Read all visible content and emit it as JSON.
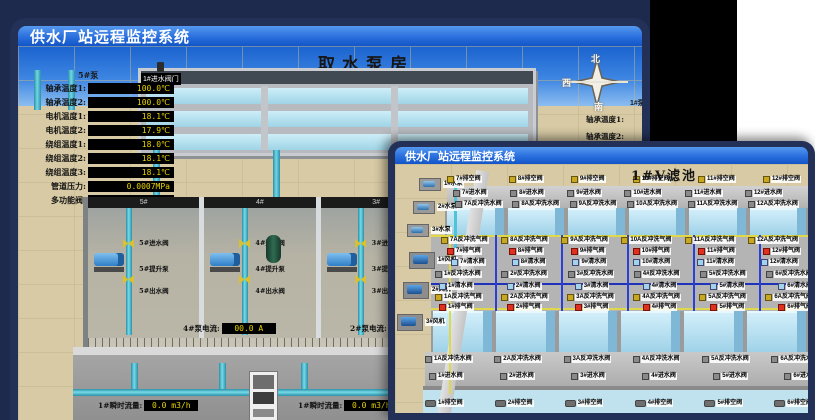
{
  "colors": {
    "titlebar_blue": "#2a6fdd",
    "value_yellow": "#e8d400",
    "alarm_red": "#e03020",
    "pipe_cyan": "#4fc3d8",
    "pipe_yellow": "#ded84a",
    "pipe_blue": "#2a3fd4",
    "water_blue": "#9fd4ea",
    "sand": "#d7caa4"
  },
  "back_window": {
    "title": "供水厂站远程监控系统",
    "scene_title": "取水泵房",
    "panel": {
      "header": "5#泵",
      "metrics": [
        {
          "label": "轴承温度1:",
          "value": "100.0℃"
        },
        {
          "label": "轴承温度2:",
          "value": "100.0℃"
        },
        {
          "label": "电机温度1:",
          "value": "18.1℃"
        },
        {
          "label": "电机温度2:",
          "value": "17.9℃"
        },
        {
          "label": "绕组温度1:",
          "value": "18.0℃"
        },
        {
          "label": "绕组温度2:",
          "value": "18.1℃"
        },
        {
          "label": "绕组温度3:",
          "value": "18.1℃"
        },
        {
          "label": "管道压力:",
          "value": "0.0007MPa"
        },
        {
          "label": "多功能阀:",
          "value": "0%"
        }
      ]
    },
    "inlet_valves": [
      "3#进水阀门",
      "2#进水阀门",
      "1#进水阀门"
    ],
    "compass": {
      "north": "北",
      "west": "西",
      "south": "南"
    },
    "side_panel": {
      "header": "1#泵",
      "labels": [
        "轴承温度1:",
        "轴承温度2:"
      ]
    },
    "pump_room": {
      "bays": [
        {
          "no": "5#",
          "inlet": "5#进水阀",
          "pump": "5#提升泵",
          "outlet": "5#出水阀"
        },
        {
          "no": "4#",
          "inlet": "4#进水阀",
          "pump": "4#提升泵",
          "outlet": "4#出水阀"
        },
        {
          "no": "3#",
          "inlet": "3#进水阀",
          "pump": "3#提升泵",
          "outlet": "3#出水阀"
        },
        {
          "no": "2#",
          "inlet": "2#进水阀",
          "pump": "2#提升泵",
          "outlet": "2#出水阀"
        }
      ],
      "current_readouts": [
        {
          "label": "4#泵电流:",
          "value": "00.0 A"
        },
        {
          "label": "2#泵电流:",
          "value": "00.0 A"
        }
      ]
    },
    "flow_readouts": [
      {
        "label": "1#瞬时流量:",
        "value": "0.0 m3/h"
      },
      {
        "label": "1#瞬时流量:",
        "value": "0.0 m3/h"
      }
    ]
  },
  "front_window": {
    "title": "供水厂站远程监控系统",
    "scene_title": "1#V滤池",
    "left_pumps": [
      "1#水泵",
      "2#水泵",
      "3#水泵"
    ],
    "left_fans": [
      "1#风机",
      "2#风机",
      "3#风机"
    ],
    "rows": {
      "upper_drain": [
        "7#排空阀",
        "8#排空阀",
        "9#排空阀",
        "10#排空阀",
        "11#排空阀",
        "12#排空阀"
      ],
      "upper_inlet": [
        "7#进水阀",
        "8#进水阀",
        "9#进水阀",
        "10#进水阀",
        "11#进水阀",
        "12#进水阀"
      ],
      "upper_backwash_water": [
        "7A反冲洗水阀",
        "8A反冲洗水阀",
        "9A反冲洗水阀",
        "10A反冲洗水阀",
        "11A反冲洗水阀",
        "12A反冲洗水阀"
      ],
      "upper_backwash_air": [
        "7A反冲洗气阀",
        "8A反冲洗气阀",
        "9A反冲洗气阀",
        "10A反冲洗气阀",
        "11A反冲洗气阀",
        "12A反冲洗气阀"
      ],
      "upper_vent": [
        "7#排气阀",
        "8#排气阀",
        "9#排气阀",
        "10#排气阀",
        "11#排气阀",
        "12#排气阀"
      ],
      "upper_clean": [
        "7#清水阀",
        "8#清水阀",
        "9#清水阀",
        "10#清水阀",
        "11#清水阀",
        "12#清水阀"
      ],
      "lower_backwash_water_b": [
        "1#反冲洗水阀",
        "2#反冲洗水阀",
        "3#反冲洗水阀",
        "4#反冲洗水阀",
        "5#反冲洗水阀",
        "6#反冲洗水阀"
      ],
      "lower_clean": [
        "1#清水阀",
        "2#清水阀",
        "3#清水阀",
        "4#清水阀",
        "5#清水阀",
        "6#清水阀"
      ],
      "lower_backwash_air": [
        "1A反冲洗气阀",
        "2A反冲洗气阀",
        "3A反冲洗气阀",
        "4A反冲洗气阀",
        "5A反冲洗气阀",
        "6A反冲洗气阀"
      ],
      "lower_vent": [
        "1#排气阀",
        "2#排气阀",
        "3#排气阀",
        "4#排气阀",
        "5#排气阀",
        "6#排气阀"
      ],
      "lower_backwash_water": [
        "1A反冲洗水阀",
        "2A反冲洗水阀",
        "3A反冲洗水阀",
        "4A反冲洗水阀",
        "5A反冲洗水阀",
        "6A反冲洗水阀"
      ],
      "lower_inlet": [
        "1#进水阀",
        "2#进水阀",
        "3#进水阀",
        "4#进水阀",
        "5#进水阀",
        "6#进水阀"
      ],
      "lower_drain": [
        "1#排空阀",
        "2#排空阀",
        "3#排空阀",
        "4#排空阀",
        "5#排空阀",
        "6#排空阀"
      ]
    }
  }
}
